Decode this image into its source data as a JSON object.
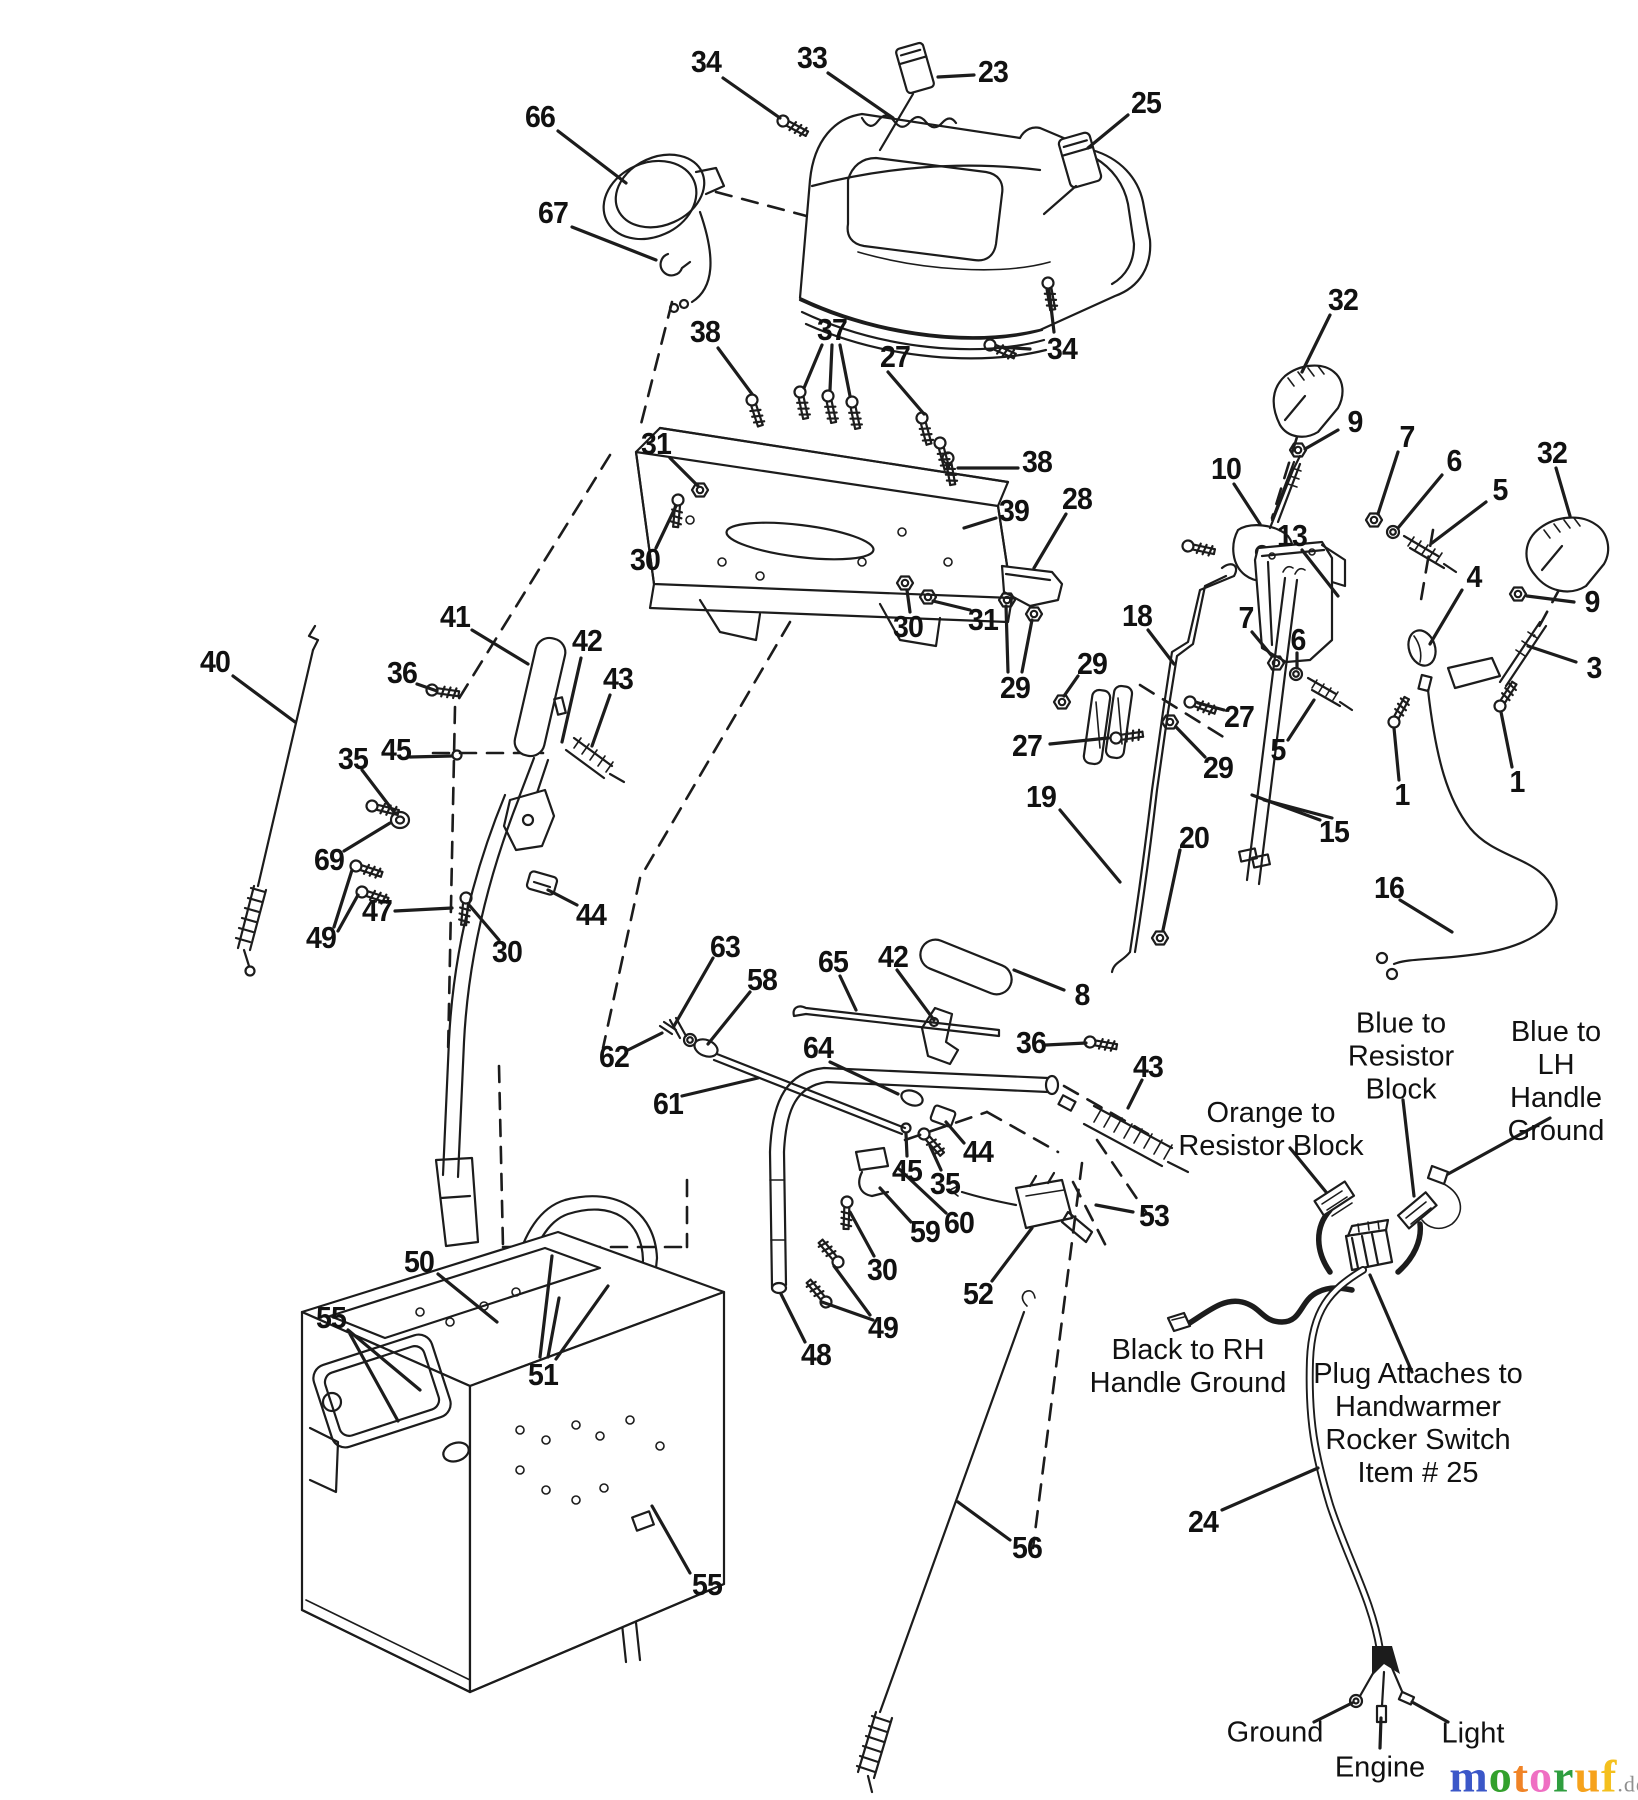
{
  "diagram": {
    "kind": "exploded-parts-diagram",
    "line_color": "#1c1c1c",
    "background": "#ffffff"
  },
  "part_labels": [
    {
      "text": "34",
      "x": 706,
      "y": 62
    },
    {
      "text": "33",
      "x": 812,
      "y": 58
    },
    {
      "text": "23",
      "x": 993,
      "y": 72
    },
    {
      "text": "25",
      "x": 1146,
      "y": 103
    },
    {
      "text": "66",
      "x": 540,
      "y": 117
    },
    {
      "text": "67",
      "x": 553,
      "y": 213
    },
    {
      "text": "38",
      "x": 705,
      "y": 332
    },
    {
      "text": "37",
      "x": 832,
      "y": 330
    },
    {
      "text": "27",
      "x": 895,
      "y": 357
    },
    {
      "text": "34",
      "x": 1062,
      "y": 349
    },
    {
      "text": "31",
      "x": 656,
      "y": 444
    },
    {
      "text": "38",
      "x": 1037,
      "y": 462
    },
    {
      "text": "39",
      "x": 1014,
      "y": 511
    },
    {
      "text": "28",
      "x": 1077,
      "y": 499
    },
    {
      "text": "30",
      "x": 645,
      "y": 560
    },
    {
      "text": "30",
      "x": 908,
      "y": 627
    },
    {
      "text": "31",
      "x": 983,
      "y": 620
    },
    {
      "text": "29",
      "x": 1015,
      "y": 688
    },
    {
      "text": "27",
      "x": 1027,
      "y": 746
    },
    {
      "text": "29",
      "x": 1092,
      "y": 664
    },
    {
      "text": "18",
      "x": 1137,
      "y": 616
    },
    {
      "text": "19",
      "x": 1041,
      "y": 797
    },
    {
      "text": "20",
      "x": 1194,
      "y": 838
    },
    {
      "text": "29",
      "x": 1218,
      "y": 768
    },
    {
      "text": "27",
      "x": 1239,
      "y": 717
    },
    {
      "text": "7",
      "x": 1246,
      "y": 618
    },
    {
      "text": "6",
      "x": 1298,
      "y": 640
    },
    {
      "text": "5",
      "x": 1278,
      "y": 750
    },
    {
      "text": "15",
      "x": 1334,
      "y": 832
    },
    {
      "text": "16",
      "x": 1389,
      "y": 888
    },
    {
      "text": "32",
      "x": 1343,
      "y": 300
    },
    {
      "text": "9",
      "x": 1355,
      "y": 422
    },
    {
      "text": "10",
      "x": 1226,
      "y": 469
    },
    {
      "text": "7",
      "x": 1407,
      "y": 437
    },
    {
      "text": "6",
      "x": 1454,
      "y": 461
    },
    {
      "text": "5",
      "x": 1500,
      "y": 490
    },
    {
      "text": "32",
      "x": 1552,
      "y": 453
    },
    {
      "text": "13",
      "x": 1292,
      "y": 536
    },
    {
      "text": "4",
      "x": 1474,
      "y": 577
    },
    {
      "text": "9",
      "x": 1592,
      "y": 602
    },
    {
      "text": "3",
      "x": 1594,
      "y": 668
    },
    {
      "text": "1",
      "x": 1402,
      "y": 795
    },
    {
      "text": "1",
      "x": 1517,
      "y": 782
    },
    {
      "text": "40",
      "x": 215,
      "y": 662
    },
    {
      "text": "41",
      "x": 455,
      "y": 617
    },
    {
      "text": "42",
      "x": 587,
      "y": 641
    },
    {
      "text": "36",
      "x": 402,
      "y": 673
    },
    {
      "text": "43",
      "x": 618,
      "y": 679
    },
    {
      "text": "45",
      "x": 396,
      "y": 750
    },
    {
      "text": "35",
      "x": 353,
      "y": 759
    },
    {
      "text": "69",
      "x": 329,
      "y": 860
    },
    {
      "text": "47",
      "x": 377,
      "y": 911
    },
    {
      "text": "49",
      "x": 321,
      "y": 938
    },
    {
      "text": "44",
      "x": 591,
      "y": 915
    },
    {
      "text": "30",
      "x": 507,
      "y": 952
    },
    {
      "text": "63",
      "x": 725,
      "y": 947
    },
    {
      "text": "58",
      "x": 762,
      "y": 980
    },
    {
      "text": "62",
      "x": 614,
      "y": 1057
    },
    {
      "text": "61",
      "x": 668,
      "y": 1104
    },
    {
      "text": "65",
      "x": 833,
      "y": 962
    },
    {
      "text": "42",
      "x": 893,
      "y": 957
    },
    {
      "text": "8",
      "x": 1082,
      "y": 995
    },
    {
      "text": "36",
      "x": 1031,
      "y": 1043
    },
    {
      "text": "43",
      "x": 1148,
      "y": 1067
    },
    {
      "text": "64",
      "x": 818,
      "y": 1048
    },
    {
      "text": "44",
      "x": 978,
      "y": 1152
    },
    {
      "text": "45",
      "x": 907,
      "y": 1171
    },
    {
      "text": "35",
      "x": 945,
      "y": 1184
    },
    {
      "text": "59",
      "x": 925,
      "y": 1232
    },
    {
      "text": "60",
      "x": 959,
      "y": 1223
    },
    {
      "text": "30",
      "x": 882,
      "y": 1270
    },
    {
      "text": "52",
      "x": 978,
      "y": 1294
    },
    {
      "text": "53",
      "x": 1154,
      "y": 1216
    },
    {
      "text": "49",
      "x": 883,
      "y": 1328
    },
    {
      "text": "48",
      "x": 816,
      "y": 1355
    },
    {
      "text": "50",
      "x": 419,
      "y": 1262
    },
    {
      "text": "55",
      "x": 331,
      "y": 1318
    },
    {
      "text": "51",
      "x": 543,
      "y": 1375
    },
    {
      "text": "55",
      "x": 707,
      "y": 1585
    },
    {
      "text": "56",
      "x": 1027,
      "y": 1548
    },
    {
      "text": "24",
      "x": 1203,
      "y": 1522
    }
  ],
  "annotations": [
    {
      "name": "blue-resistor-block",
      "lines": [
        "Blue to",
        "Resistor",
        "Block"
      ],
      "x": 1401,
      "y": 1057
    },
    {
      "name": "blue-lh-handle-ground",
      "lines": [
        "Blue to LH",
        "Handle Ground"
      ],
      "x": 1556,
      "y": 1082
    },
    {
      "name": "orange-resistor-block",
      "lines": [
        "Orange to",
        "Resistor Block"
      ],
      "x": 1271,
      "y": 1130
    },
    {
      "name": "black-rh-handle-ground",
      "lines": [
        "Black to RH",
        "Handle Ground"
      ],
      "x": 1188,
      "y": 1367
    },
    {
      "name": "plug-attaches",
      "lines": [
        "Plug Attaches to",
        "Handwarmer",
        "Rocker Switch",
        "Item # 25"
      ],
      "x": 1418,
      "y": 1424
    },
    {
      "name": "ground",
      "lines": [
        "Ground"
      ],
      "x": 1275,
      "y": 1733
    },
    {
      "name": "engine",
      "lines": [
        "Engine"
      ],
      "x": 1380,
      "y": 1768
    },
    {
      "name": "light",
      "lines": [
        "Light"
      ],
      "x": 1473,
      "y": 1734
    }
  ],
  "watermark": {
    "x": 1548,
    "y": 1776,
    "letters": [
      {
        "ch": "m",
        "color": "#3b57c8"
      },
      {
        "ch": "o",
        "color": "#33a02c"
      },
      {
        "ch": "t",
        "color": "#f08326"
      },
      {
        "ch": "o",
        "color": "#ef6fc3"
      },
      {
        "ch": "r",
        "color": "#2f9e3f"
      },
      {
        "ch": "u",
        "color": "#f6a21c"
      },
      {
        "ch": "f",
        "color": "#f4c01e"
      }
    ],
    "suffix": ".de",
    "suffix_color": "#8f8f8f"
  }
}
